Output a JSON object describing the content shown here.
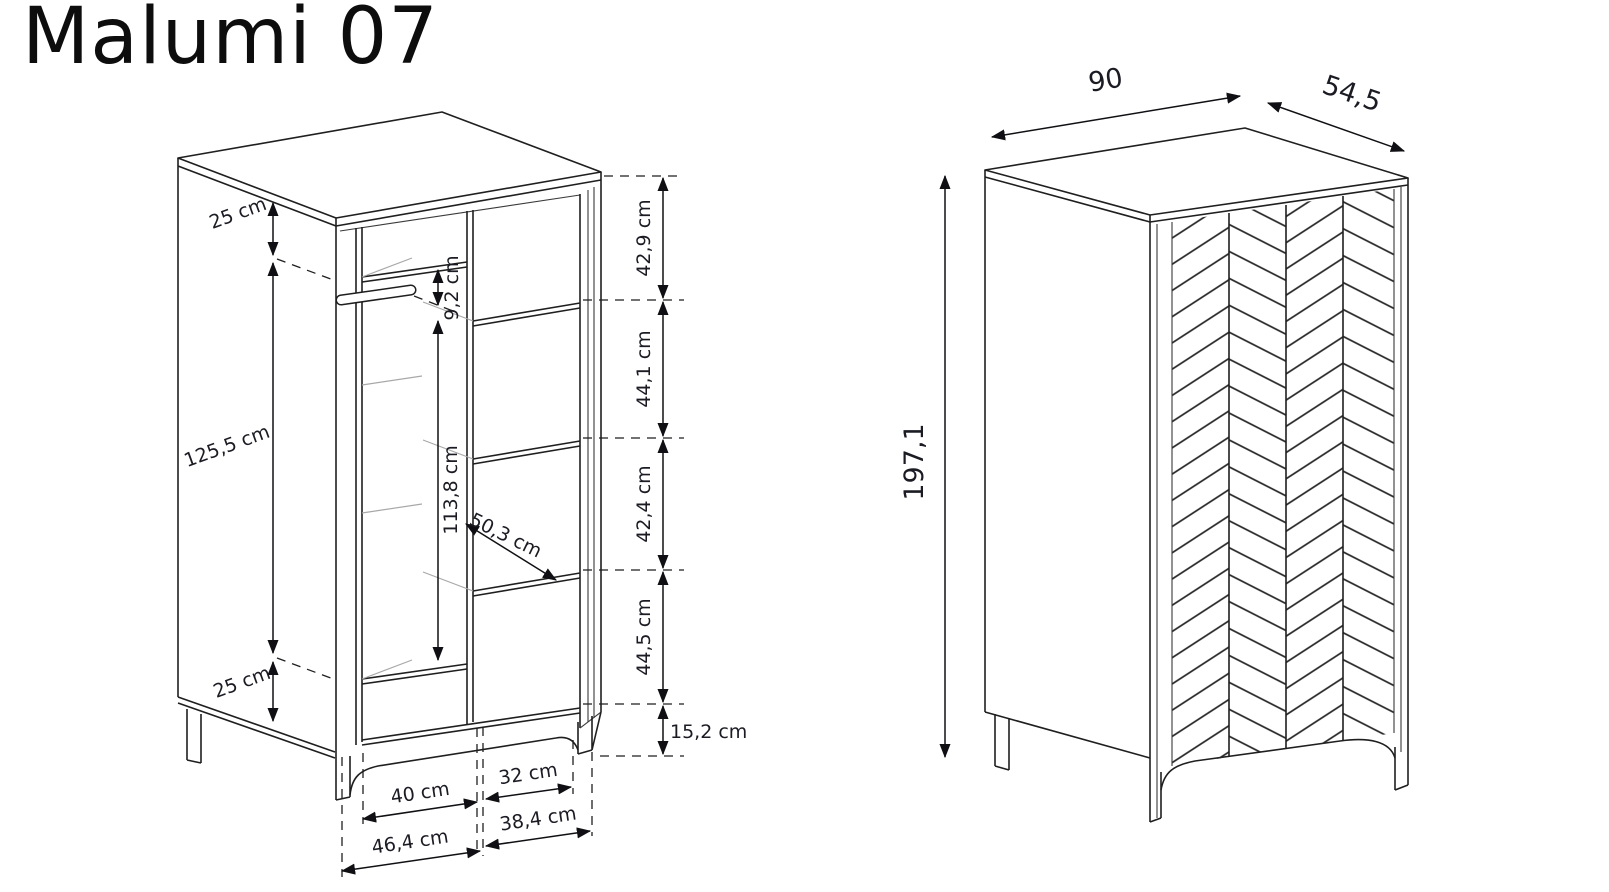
{
  "title": "Malumi 07",
  "views": {
    "interior": {
      "name": "interior-dimension-view",
      "dims": {
        "top_section": "25 cm",
        "hanging_section": "125,5 cm",
        "bottom_section": "25 cm",
        "rod_drop": "9,2 cm",
        "hanging_height": "113,8 cm",
        "shelf_depth": "50,3 cm",
        "gap_1": "42,9 cm",
        "gap_2": "44,1 cm",
        "gap_3": "42,4 cm",
        "gap_4": "44,5 cm",
        "plinth_height": "15,2 cm",
        "left_inner_width": "40 cm",
        "right_inner_width": "32 cm",
        "left_outer_width": "46,4 cm",
        "right_outer_width": "38,4 cm"
      }
    },
    "exterior": {
      "name": "exterior-dimension-view",
      "dims": {
        "width": "90",
        "depth": "54,5",
        "height": "197,1"
      }
    }
  },
  "colors": {
    "line": "#1f1f1f",
    "light_line": "#a8a8a8",
    "dim_text": "#1b1b24",
    "background": "#ffffff"
  }
}
